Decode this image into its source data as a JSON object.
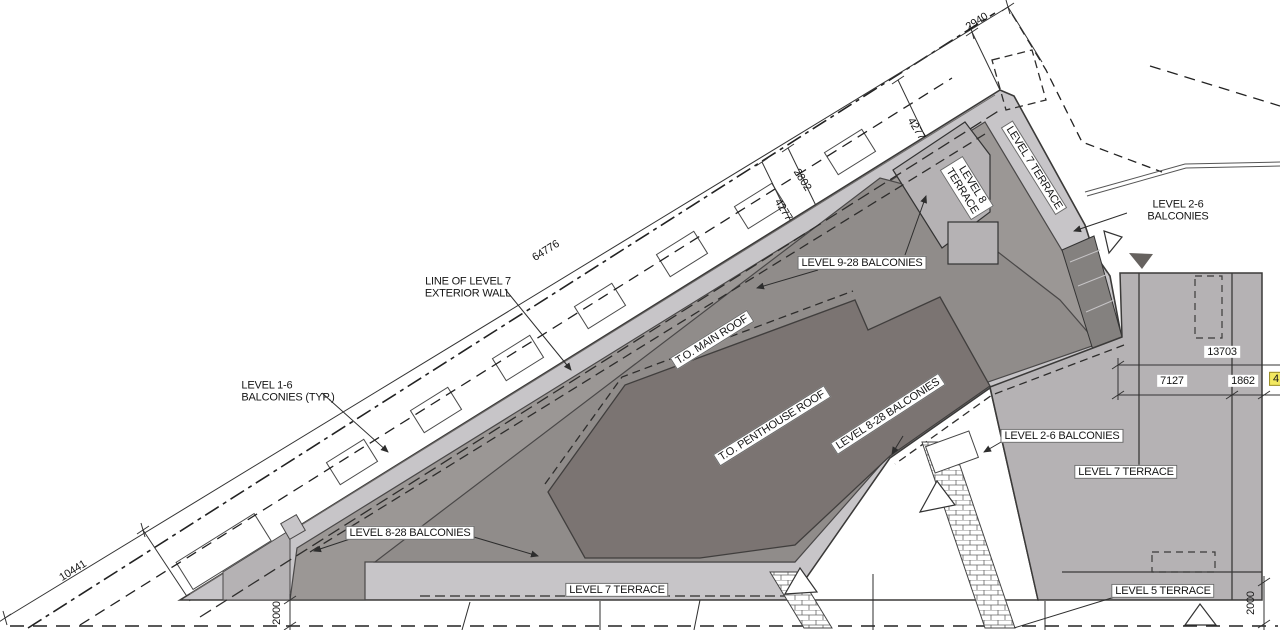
{
  "drawing": {
    "type": "roof-plan",
    "highlight_value": "4"
  },
  "colors": {
    "terrace_light": "#c7c5c8",
    "terrace_mid": "#b5b2b4",
    "band_mid": "#9b9795",
    "roof_main": "#908c8a",
    "roof_penthouse": "#7b7472",
    "hatch_dark": "#84817f",
    "line_dark": "#3b3a39",
    "highlight_yellow": "#f2e860"
  },
  "labels": [
    {
      "name": "dim-2940",
      "text": "2940",
      "x": 977,
      "y": 22,
      "rot": -32,
      "style": "plain"
    },
    {
      "name": "dim-4277-upper",
      "text": "4277",
      "x": 916,
      "y": 129,
      "rot": 58,
      "style": "plain"
    },
    {
      "name": "dim-2802",
      "text": "2802",
      "x": 802,
      "y": 180,
      "rot": 58,
      "style": "plain"
    },
    {
      "name": "dim-4277-lower",
      "text": "4277",
      "x": 783,
      "y": 210,
      "rot": 58,
      "style": "plain"
    },
    {
      "name": "dim-64776",
      "text": "64776",
      "x": 546,
      "y": 251,
      "rot": -32,
      "style": "plain"
    },
    {
      "name": "dim-10441",
      "text": "10441",
      "x": 73,
      "y": 571,
      "rot": -32,
      "style": "plain"
    },
    {
      "name": "dim-13703",
      "text": "13703",
      "x": 1222,
      "y": 352,
      "rot": 0,
      "style": "white"
    },
    {
      "name": "dim-7127",
      "text": "7127",
      "x": 1172,
      "y": 381,
      "rot": 0,
      "style": "white"
    },
    {
      "name": "dim-1862",
      "text": "1862",
      "x": 1243,
      "y": 381,
      "rot": 0,
      "style": "white"
    },
    {
      "name": "dim-highlighted",
      "text": "4",
      "x": 1276,
      "y": 379,
      "rot": 0,
      "style": "highlight"
    },
    {
      "name": "dim-2000-left",
      "text": "2000",
      "x": 277,
      "y": 613,
      "rot": -90,
      "style": "plain"
    },
    {
      "name": "dim-2000-right",
      "text": "2000",
      "x": 1251,
      "y": 603,
      "rot": -90,
      "style": "plain"
    },
    {
      "name": "note-line-of-level7",
      "text": "LINE OF LEVEL 7\nEXTERIOR WALL",
      "x": 468,
      "y": 288,
      "rot": 0,
      "style": "plain"
    },
    {
      "name": "note-level-1-6-balconies",
      "text": "LEVEL 1-6\nBALCONIES (TYP.)",
      "x": 288,
      "y": 392,
      "rot": 0,
      "style": "plain left"
    },
    {
      "name": "note-level-9-28-balconies",
      "text": "LEVEL 9-28 BALCONIES",
      "x": 862,
      "y": 263,
      "rot": 0,
      "style": "boxed"
    },
    {
      "name": "note-level-7-terrace-top",
      "text": "LEVEL 7 TERRACE",
      "x": 1034,
      "y": 168,
      "rot": 58,
      "style": "boxed"
    },
    {
      "name": "note-level-8-terrace",
      "text": "LEVEL 8\nTERRACE",
      "x": 967,
      "y": 188,
      "rot": 58,
      "style": "boxed"
    },
    {
      "name": "note-level-2-6-balconies-top",
      "text": "LEVEL 2-6 BALCONIES",
      "x": 1178,
      "y": 211,
      "rot": 0,
      "style": "white"
    },
    {
      "name": "note-to-main-roof",
      "text": "T.O. MAIN ROOF",
      "x": 712,
      "y": 340,
      "rot": -32,
      "style": "boxed"
    },
    {
      "name": "note-to-penthouse-roof",
      "text": "T.O. PENTHOUSE ROOF",
      "x": 772,
      "y": 426,
      "rot": -32,
      "style": "boxed"
    },
    {
      "name": "note-level-8-28-balconies-mid",
      "text": "LEVEL 8-28 BALCONIES",
      "x": 888,
      "y": 414,
      "rot": -33,
      "style": "boxed"
    },
    {
      "name": "note-level-2-6-balconies-right",
      "text": "LEVEL 2-6 BALCONIES",
      "x": 1062,
      "y": 436,
      "rot": 0,
      "style": "boxed"
    },
    {
      "name": "note-level-7-terrace-right",
      "text": "LEVEL 7 TERRACE",
      "x": 1126,
      "y": 472,
      "rot": 0,
      "style": "boxed"
    },
    {
      "name": "note-level-8-28-balconies-bottom",
      "text": "LEVEL 8-28 BALCONIES",
      "x": 410,
      "y": 533,
      "rot": 0,
      "style": "boxed"
    },
    {
      "name": "note-level-7-terrace-bottom",
      "text": "LEVEL 7 TERRACE",
      "x": 617,
      "y": 590,
      "rot": 0,
      "style": "boxed"
    },
    {
      "name": "note-level-5-terrace",
      "text": "LEVEL 5 TERRACE",
      "x": 1163,
      "y": 591,
      "rot": 0,
      "style": "boxed"
    }
  ]
}
